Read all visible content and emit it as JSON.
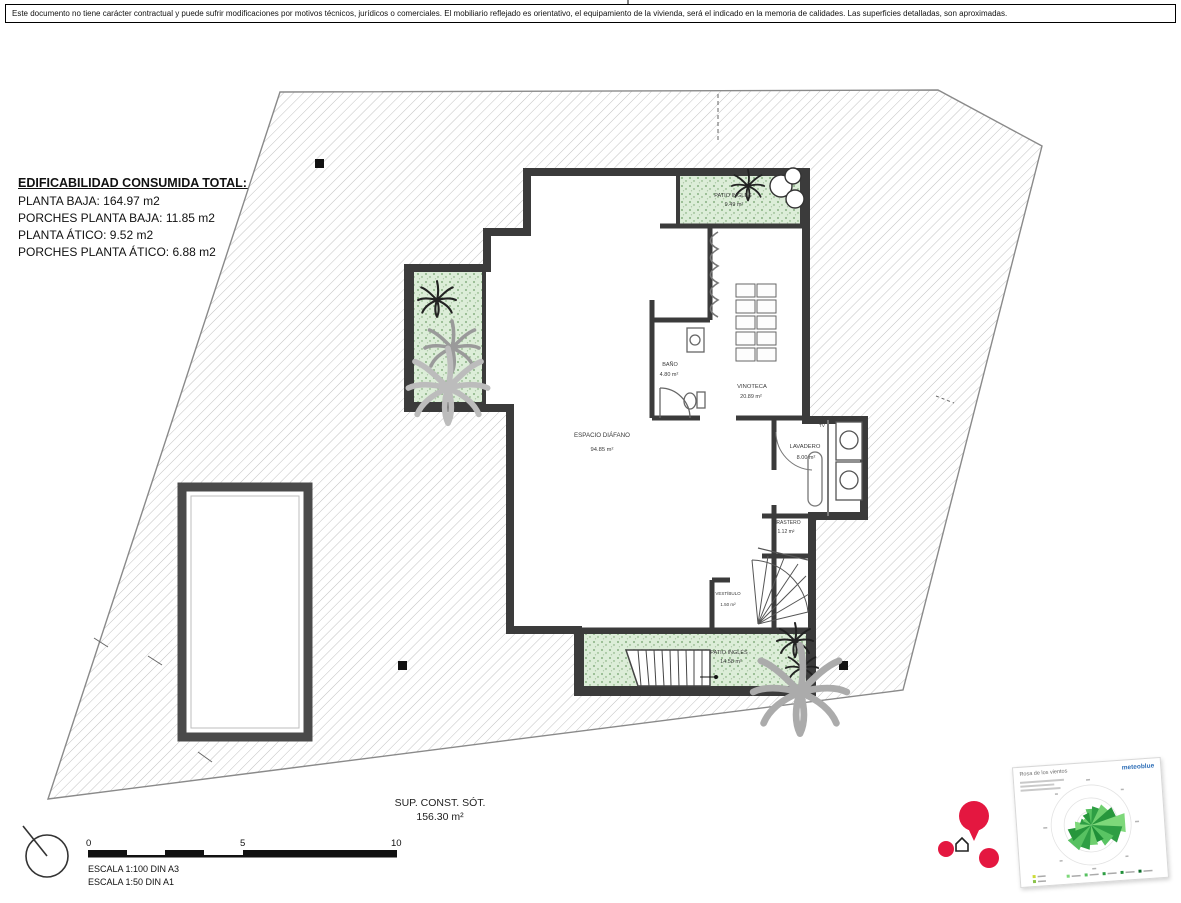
{
  "page": {
    "disclaimer": "Este documento no tiene carácter contractual y puede sufrir modificaciones por motivos técnicos, jurídicos o comerciales. El mobiliario reflejado es orientativo, el equipamiento de la vivienda, será el indicado en la memoria de calidades. Las superficies detalladas, son aproximadas."
  },
  "summary": {
    "title": "EDIFICABILIDAD CONSUMIDA TOTAL: 193.22 m2",
    "lines": [
      "PLANTA BAJA: 164.97 m2",
      "PORCHES PLANTA BAJA: 11.85 m2",
      "PLANTA ÁTICO: 9.52 m2",
      "PORCHES PLANTA ÁTICO: 6.88 m2"
    ]
  },
  "rooms": [
    {
      "name": "PATIO INGLÉS",
      "area": "9.49 m²"
    },
    {
      "name": "BAÑO",
      "area": "4.80 m²"
    },
    {
      "name": "VINOTECA",
      "area": "20.89 m²"
    },
    {
      "name": "ESPACIO DIÁFANO",
      "area": "94.85 m²"
    },
    {
      "name": "LAVADERO",
      "area": "8.00 m²"
    },
    {
      "name": "TRASTERO",
      "area": "1.12 m²"
    },
    {
      "name": "VESTÍBULO",
      "area": "1.50 m²"
    },
    {
      "name": "PATIO INGLÉS",
      "area": "14.58 m²"
    }
  ],
  "labels": {
    "tv": "TV"
  },
  "footer": {
    "sup_const_label": "SUP. CONST. SÓT.",
    "sup_const_value": "156.30 m²",
    "scale_tick_0": "0",
    "scale_tick_5": "5",
    "scale_tick_10": "10",
    "scale_line1": "ESCALA 1:100 DIN A3",
    "scale_line2": "ESCALA 1:50 DIN A1"
  },
  "windrose": {
    "title": "Rosa de los vientos",
    "brand": "meteoblue"
  },
  "colors": {
    "wall": "#3b3b3b",
    "hatch_line": "#c2c2c2",
    "patio_green": "#dcedd8",
    "marker_red": "#e41740",
    "brand_blue": "#2f6fb7"
  }
}
